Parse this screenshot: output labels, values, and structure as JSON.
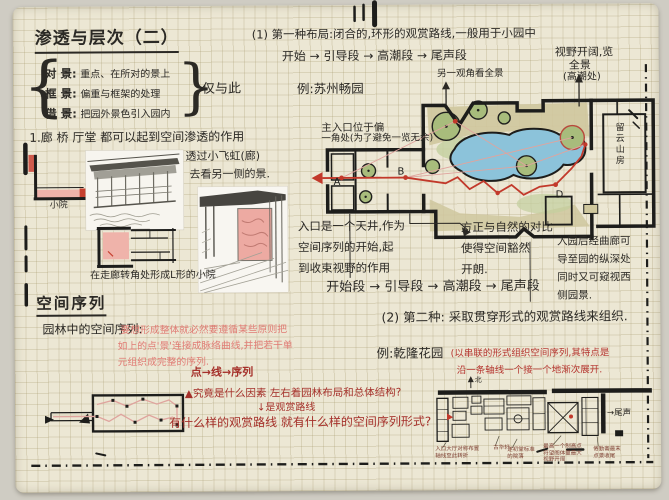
{
  "colors": {
    "ink": "#2b2925",
    "route_red": "#c2392b",
    "pink_text": "#e07b74",
    "dark_red": "#a5302a",
    "pond_blue": "#8cc3da",
    "tree_green": "#a8bc7c",
    "ground_tan": "#cfc79d",
    "pink_fill": "#efb3aa",
    "paper": "#ece7d4"
  },
  "header": {
    "title": "渗透与层次（二）",
    "brace_note": "仅与此"
  },
  "jing_list": {
    "items": [
      {
        "term": "对 景:",
        "desc": "重点、在所对的景上"
      },
      {
        "term": "框 景:",
        "desc": "偏重与框架的处理"
      },
      {
        "term": "借 景:",
        "desc": "把园外景色引入园内"
      }
    ]
  },
  "type1": {
    "intro": "(1) 第一种布局:闭合的,环形的观赏路线,一般用于小园中",
    "sequence_top": "开始 → 引导段 → 高潮段 → 尾声段",
    "example": "例:苏州畅园",
    "view_note": [
      "视野开阔,览",
      "全景",
      "(高潮处)"
    ],
    "angle_note": "另一观角看全景",
    "entry_note": [
      "主入口位于偏",
      "一角处(为了避免一览无余)"
    ],
    "tianjing": [
      "入口是一个天井,作为",
      "空间序列的开始,起",
      "到收束视野的作用"
    ],
    "contrast": [
      "方正与自然的对比",
      "使得空间豁然",
      "开朗."
    ],
    "corridor": [
      "入园后经曲廊可",
      "导至园的纵深处",
      "同时又可窥视西",
      "侧园景."
    ],
    "sequence_main": "开始段 → 引导段 → 高潮段 → 尾声段",
    "plan": {
      "point_a": "A",
      "point_b": "B",
      "point_d": "D",
      "hall": "留云山房"
    }
  },
  "type2": {
    "intro": "(2) 第二种: 采取贯穿形式的观赏路线来组织.",
    "example": "例:乾隆花园",
    "example_note": [
      "(以串联的形式组织空间序列,其特点是",
      "沿一条轴线一个接一个地渐次展开."
    ],
    "north": "北",
    "tail": "→尾声",
    "annotations": {
      "a1": [
        "入口大厅对称布置",
        "轴线至此转折"
      ],
      "a2": [
        "古华轩"
      ],
      "a3": [
        "遂初堂标准",
        "的院落"
      ],
      "a4": [
        "最高一个制高点",
        "符望阁体量最大",
        "视野开阔"
      ],
      "a5": [
        "倦勤斋最末",
        "点景收尾"
      ]
    }
  },
  "penetration": {
    "line": "1.廊 桥 厅堂 都可以起到空间渗透的作用",
    "feihong": [
      "透过小飞虹(廊)",
      "去看另一侧的景."
    ],
    "court_label": "小院",
    "l_caption": "在走廊转角处形成L形的小院"
  },
  "sequence": {
    "heading": "空间序列",
    "lead": "园林中的空间序列:",
    "pink": [
      "要想形成整体就必然要遵循某些原则把",
      "如上的点'景'连接成脉络曲线,并把若干单",
      "元组织成完整的序列."
    ],
    "point_line": "点→线→序列",
    "q1": "▲究竟是什么因素 左右着园林布局和总体结构?",
    "q1b": "↓是观赏路线",
    "q2": "有什么样的观赏路线 就有什么样的空间序列形式?"
  }
}
